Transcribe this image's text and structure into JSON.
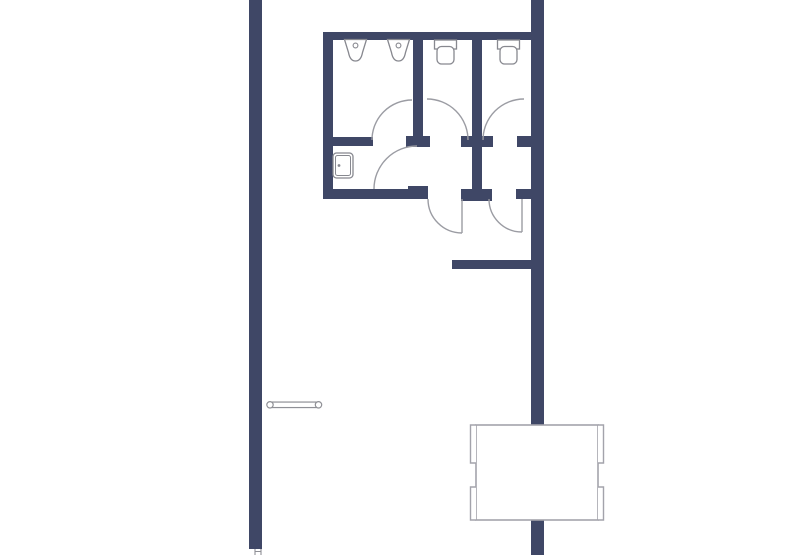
{
  "document": {
    "type": "floor-plan-drawing",
    "background": "#ffffff"
  },
  "colors": {
    "wall": "#3f4766",
    "fixture_line": "#87888f",
    "door_arc_line": "#9b9ca3",
    "furniture_line": "#a3a3ab",
    "bench_line": "#8f9096",
    "fill": "#ffffff"
  },
  "plan": {
    "canvas": {
      "w": 794,
      "h": 555
    },
    "walls": [
      {
        "name": "left-corridor-wall",
        "x": 249,
        "y": 0,
        "w": 13,
        "h": 549
      },
      {
        "name": "right-corridor-wall",
        "x": 531,
        "y": 0,
        "w": 13,
        "h": 555
      },
      {
        "name": "restroom-top-wall",
        "x": 323,
        "y": 32,
        "w": 221,
        "h": 8
      },
      {
        "name": "restroom-left-wall",
        "x": 323,
        "y": 32,
        "w": 10,
        "h": 167
      },
      {
        "name": "urinal-partition-wall",
        "x": 323,
        "y": 137,
        "w": 50,
        "h": 9
      },
      {
        "name": "restroom-bottom-wall-left",
        "x": 323,
        "y": 189,
        "w": 105,
        "h": 10
      },
      {
        "name": "bottom-wall-hinge-cap-left",
        "x": 408,
        "y": 186,
        "w": 20,
        "h": 13
      },
      {
        "name": "stall-partition-left",
        "x": 413,
        "y": 32,
        "w": 10,
        "h": 106
      },
      {
        "name": "stall-partition-left-hinge-cap",
        "x": 406,
        "y": 136,
        "w": 24,
        "h": 11
      },
      {
        "name": "center-partition-wall",
        "x": 472,
        "y": 32,
        "w": 10,
        "h": 167
      },
      {
        "name": "center-partition-mid-cap",
        "x": 461,
        "y": 136,
        "w": 32,
        "h": 11
      },
      {
        "name": "center-partition-bottom-cap",
        "x": 461,
        "y": 189,
        "w": 31,
        "h": 12
      },
      {
        "name": "right-wall-mid-cap",
        "x": 517,
        "y": 136,
        "w": 14,
        "h": 11
      },
      {
        "name": "right-wall-bottom-cap",
        "x": 516,
        "y": 189,
        "w": 15,
        "h": 10
      },
      {
        "name": "hallway-wall",
        "x": 452,
        "y": 260,
        "w": 92,
        "h": 9
      }
    ],
    "doors": [
      {
        "name": "urinal-room-door",
        "arc": "M372 140 A40 40 0 0 1 412 100"
      },
      {
        "name": "washroom-lobby-door",
        "arc": "M374 189 A43 43 0 0 1 417 146"
      },
      {
        "name": "left-stall-door",
        "arc": "M427 99 A41 41 0 0 1 468 140"
      },
      {
        "name": "right-stall-door",
        "arc": "M483 140 A41 41 0 0 1 524 99"
      },
      {
        "name": "left-entry-door",
        "arc": "M428 199 A34 34 0 0 0 462 233",
        "leaf": "M462 199 L462 233"
      },
      {
        "name": "right-entry-door",
        "arc": "M489 199 A33 33 0 0 0 522 232",
        "leaf": "M522 199 L522 232"
      }
    ],
    "fixtures": {
      "urinals": [
        {
          "name": "urinal-1",
          "cx": 355.5,
          "top": 39.5
        },
        {
          "name": "urinal-2",
          "cx": 398.5,
          "top": 39.5
        }
      ],
      "toilets": [
        {
          "name": "toilet-1",
          "cx": 445.5,
          "top": 40
        },
        {
          "name": "toilet-2",
          "cx": 508.5,
          "top": 40
        }
      ],
      "sink": {
        "name": "sink",
        "x": 333,
        "y": 153,
        "w": 20,
        "h": 25,
        "faucet_cx": 339,
        "faucet_cy": 165.5
      }
    },
    "furniture": {
      "bench": {
        "name": "wall-bench",
        "x1": 270,
        "x2": 318.5,
        "cy": 404.8,
        "bar_h": 5.5,
        "end_r": 3.2
      },
      "table": {
        "name": "table",
        "x": 476,
        "y": 425,
        "w": 122,
        "h": 95,
        "tab_out": 5.5,
        "tabs": [
          {
            "side": "left",
            "y1": 425,
            "y2": 463
          },
          {
            "side": "left",
            "y1": 487,
            "y2": 520
          },
          {
            "side": "right",
            "y1": 425,
            "y2": 463
          },
          {
            "side": "right",
            "y1": 487,
            "y2": 520
          }
        ]
      },
      "threshold": {
        "name": "door-threshold",
        "x1": 255,
        "x2": 261,
        "y1": 549,
        "y2": 555,
        "mid_y": 551.5
      }
    }
  }
}
